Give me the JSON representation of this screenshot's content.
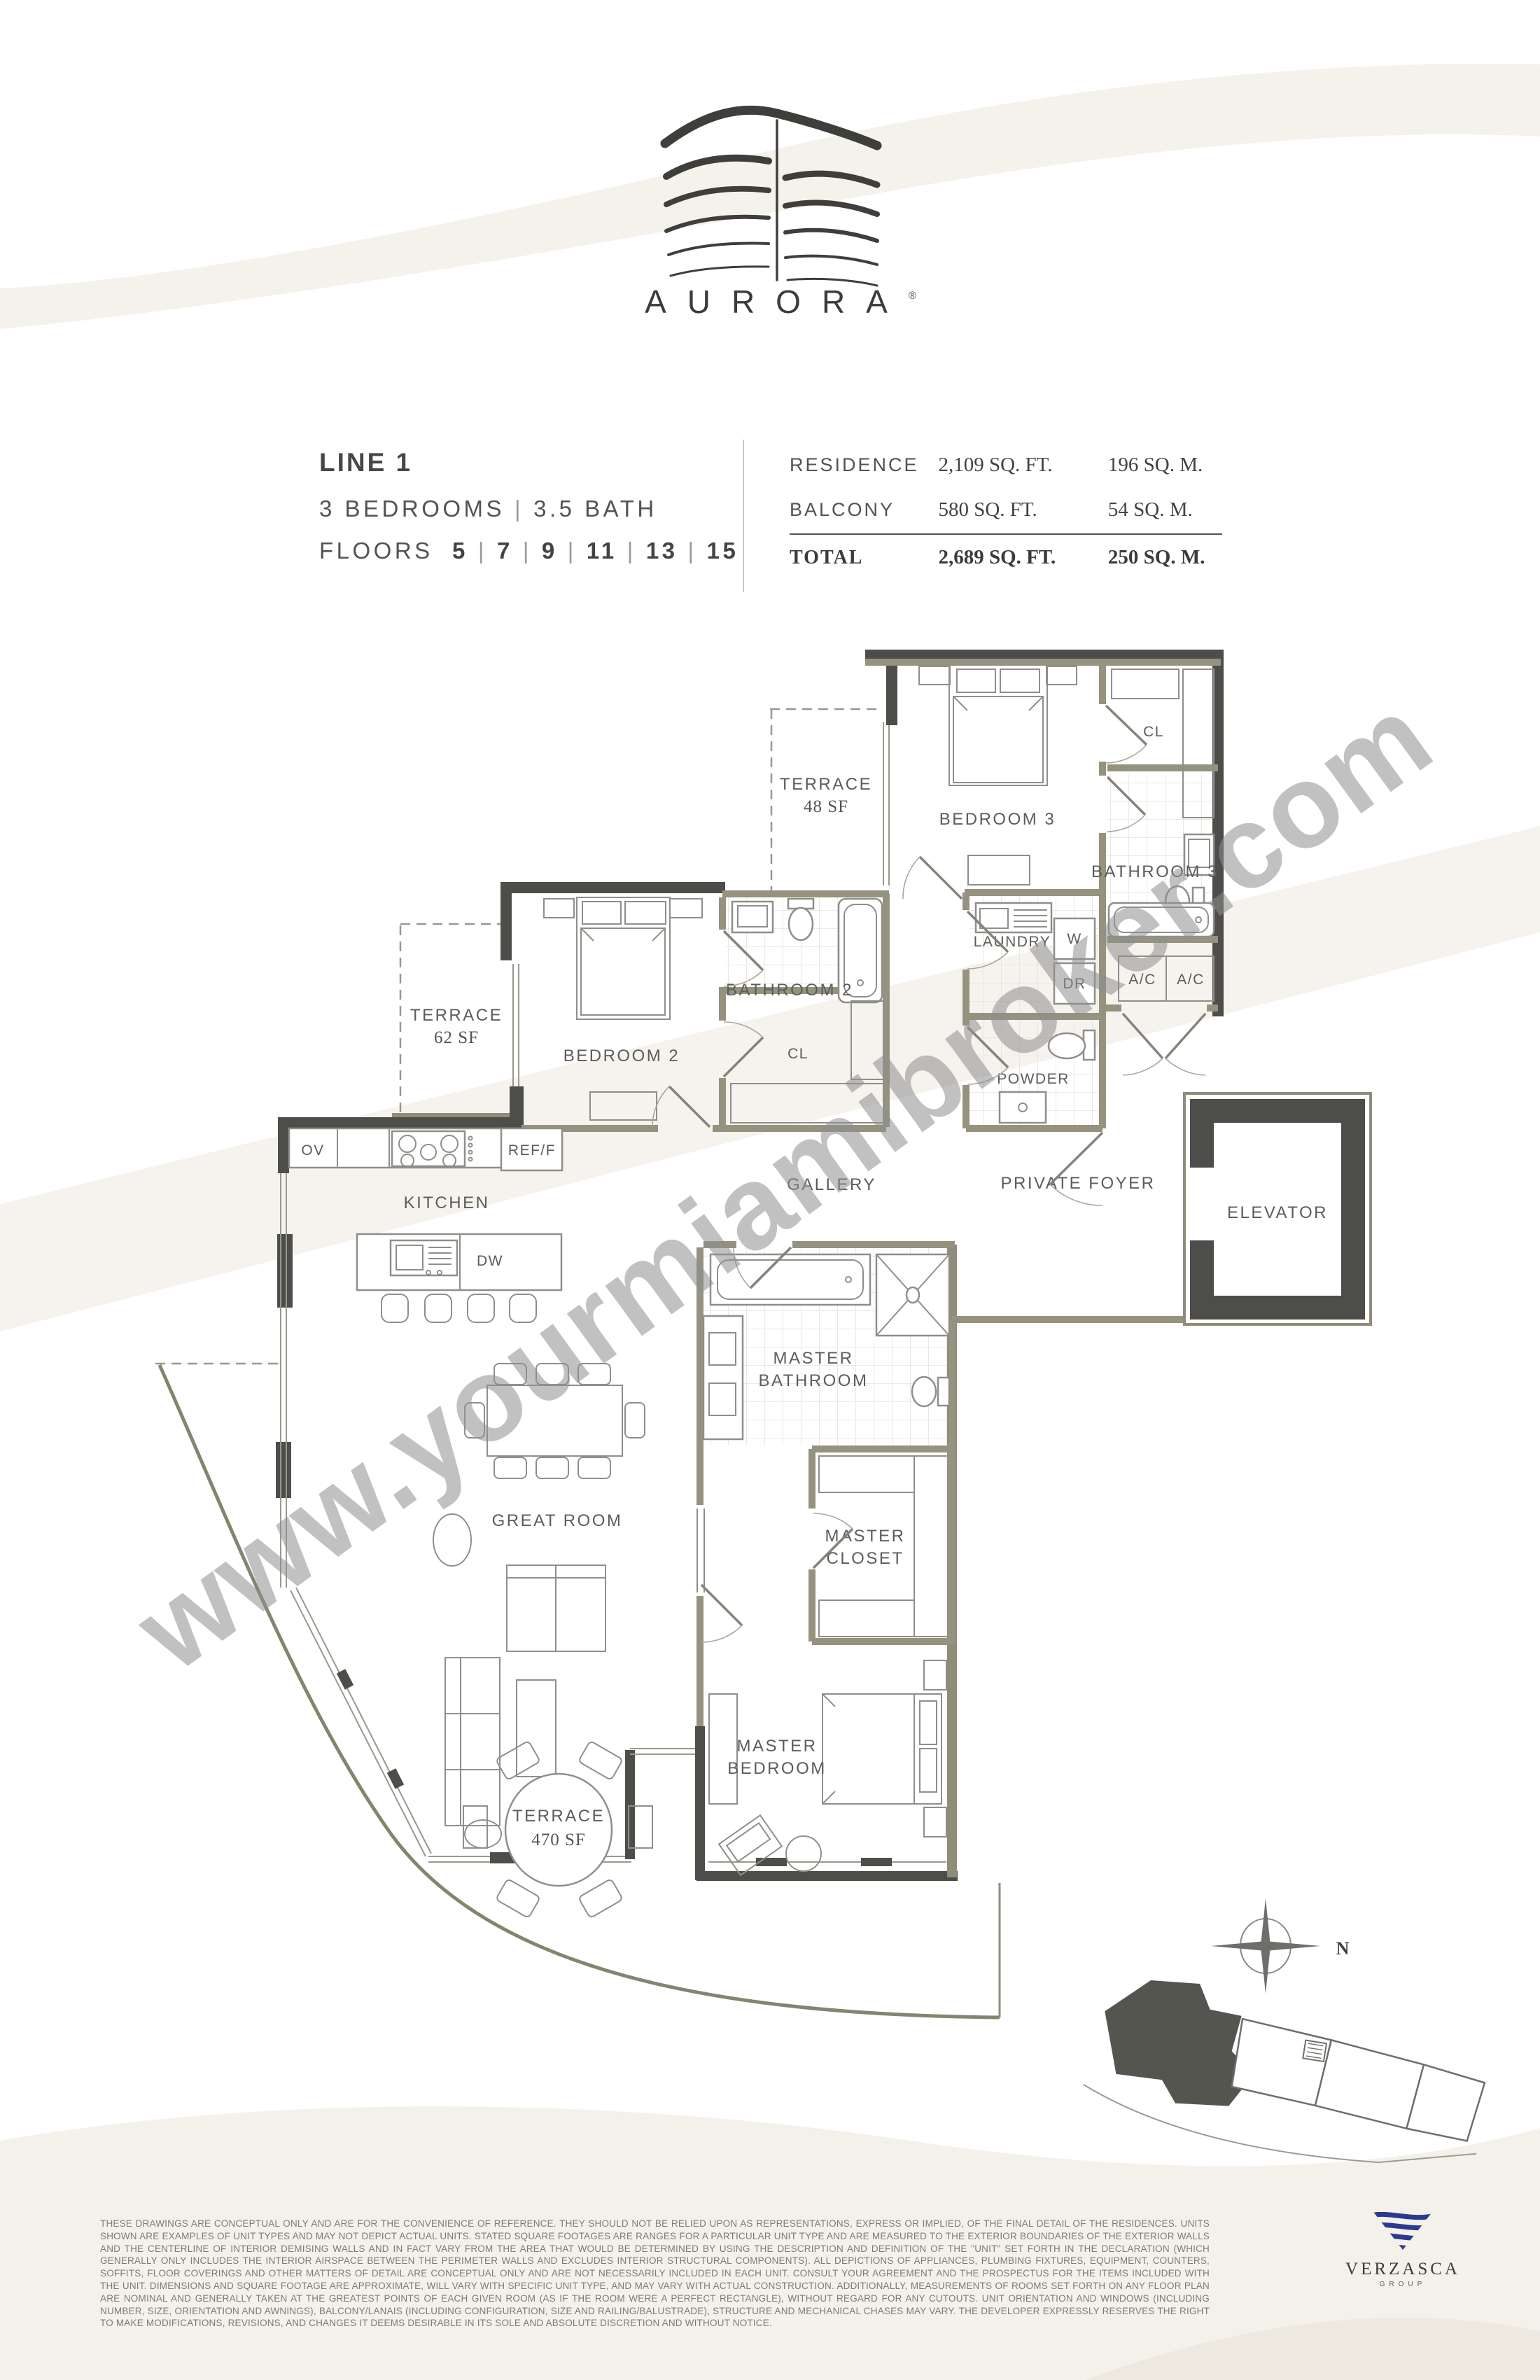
{
  "brand": {
    "name": "AURORA",
    "registered": "®"
  },
  "unit": {
    "line": "LINE 1",
    "bedrooms": "3 BEDROOMS",
    "bath": "3.5 BATH",
    "sep": "|",
    "floors_label": "FLOORS",
    "floors": [
      "5",
      "7",
      "9",
      "11",
      "13",
      "15"
    ]
  },
  "areas": {
    "rows": [
      {
        "label": "RESIDENCE",
        "sqft": "2,109 SQ. FT.",
        "sqm": "196 SQ. M."
      },
      {
        "label": "BALCONY",
        "sqft": "580 SQ. FT.",
        "sqm": "54 SQ. M."
      },
      {
        "label": "TOTAL",
        "sqft": "2,689 SQ. FT.",
        "sqm": "250 SQ. M."
      }
    ]
  },
  "plan": {
    "rooms": {
      "terrace48_name": "TERRACE",
      "terrace48_area": "48 SF",
      "bedroom3": "BEDROOM 3",
      "cl_top": "CL",
      "bathroom3": "BATHROOM 3",
      "laundry": "LAUNDRY",
      "washer": "W",
      "dryer": "DR",
      "ac1": "A/C",
      "ac2": "A/C",
      "powder": "POWDER",
      "terrace62_name": "TERRACE",
      "terrace62_area": "62 SF",
      "bedroom2": "BEDROOM 2",
      "bathroom2": "BATHROOM 2",
      "cl_bed2": "CL",
      "ov": "OV",
      "kitchen": "KITCHEN",
      "ref": "REF/F",
      "dw": "DW",
      "gallery": "GALLERY",
      "private_foyer": "PRIVATE FOYER",
      "elevator": "ELEVATOR",
      "great_room": "GREAT ROOM",
      "master_bathroom_1": "MASTER",
      "master_bathroom_2": "BATHROOM",
      "master_closet_1": "MASTER",
      "master_closet_2": "CLOSET",
      "master_bedroom_1": "MASTER",
      "master_bedroom_2": "BEDROOM",
      "terrace470_name": "TERRACE",
      "terrace470_area": "470 SF"
    }
  },
  "watermark": {
    "text": "www.yourmiamibroker.com"
  },
  "compass": {
    "north": "N"
  },
  "disclaimer": {
    "text": "THESE DRAWINGS ARE CONCEPTUAL ONLY AND ARE FOR THE CONVENIENCE OF REFERENCE. THEY SHOULD NOT BE RELIED UPON AS REPRESENTATIONS, EXPRESS OR IMPLIED, OF THE FINAL DETAIL OF THE RESIDENCES. UNITS SHOWN ARE EXAMPLES OF UNIT TYPES AND MAY NOT DEPICT ACTUAL UNITS. STATED SQUARE FOOTAGES ARE RANGES FOR A PARTICULAR UNIT TYPE AND ARE MEASURED TO THE EXTERIOR BOUNDARIES OF THE EXTERIOR WALLS AND THE CENTERLINE OF INTERIOR DEMISING WALLS AND IN FACT VARY FROM THE AREA THAT WOULD BE DETERMINED BY USING THE DESCRIPTION AND DEFINITION OF THE \"UNIT\" SET FORTH IN THE DECLARATION (WHICH GENERALLY ONLY INCLUDES THE INTERIOR AIRSPACE BETWEEN THE PERIMETER WALLS AND EXCLUDES INTERIOR STRUCTURAL COMPONENTS). ALL DEPICTIONS OF APPLIANCES, PLUMBING FIXTURES, EQUIPMENT, COUNTERS, SOFFITS, FLOOR COVERINGS AND OTHER MATTERS OF DETAIL ARE CONCEPTUAL ONLY AND ARE NOT NECESSARILY INCLUDED IN EACH UNIT. CONSULT YOUR AGREEMENT AND THE PROSPECTUS FOR THE ITEMS INCLUDED WITH THE UNIT. DIMENSIONS AND SQUARE FOOTAGE ARE APPROXIMATE, WILL VARY WITH SPECIFIC UNIT TYPE, AND MAY VARY WITH ACTUAL CONSTRUCTION. ADDITIONALLY, MEASUREMENTS OF ROOMS SET FORTH ON ANY FLOOR PLAN ARE NOMINAL AND GENERALLY TAKEN AT THE GREATEST POINTS OF EACH GIVEN ROOM (AS IF THE ROOM WERE A PERFECT RECTANGLE), WITHOUT REGARD FOR ANY CUTOUTS. UNIT ORIENTATION AND WINDOWS (INCLUDING NUMBER, SIZE, ORIENTATION AND AWNINGS), BALCONY/LANAIS (INCLUDING CONFIGURATION, SIZE AND RAILING/BALUSTRADE), STRUCTURE AND MECHANICAL CHASES MAY VARY. THE DEVELOPER EXPRESSLY RESERVES THE RIGHT TO MAKE MODIFICATIONS, REVISIONS, AND CHANGES IT DEEMS DESIRABLE IN ITS SOLE AND ABSOLUTE DISCRETION AND WITHOUT NOTICE."
  },
  "developer": {
    "name": "VERZASCA",
    "group": "GROUP"
  },
  "colors": {
    "wall_dark": "#4d4d4a",
    "wall_olive": "#95927f",
    "label": "#5c5c5a",
    "navy": "#2b3990",
    "watermark": "#8f8f8f",
    "swoosh": "#f5f2ec"
  }
}
